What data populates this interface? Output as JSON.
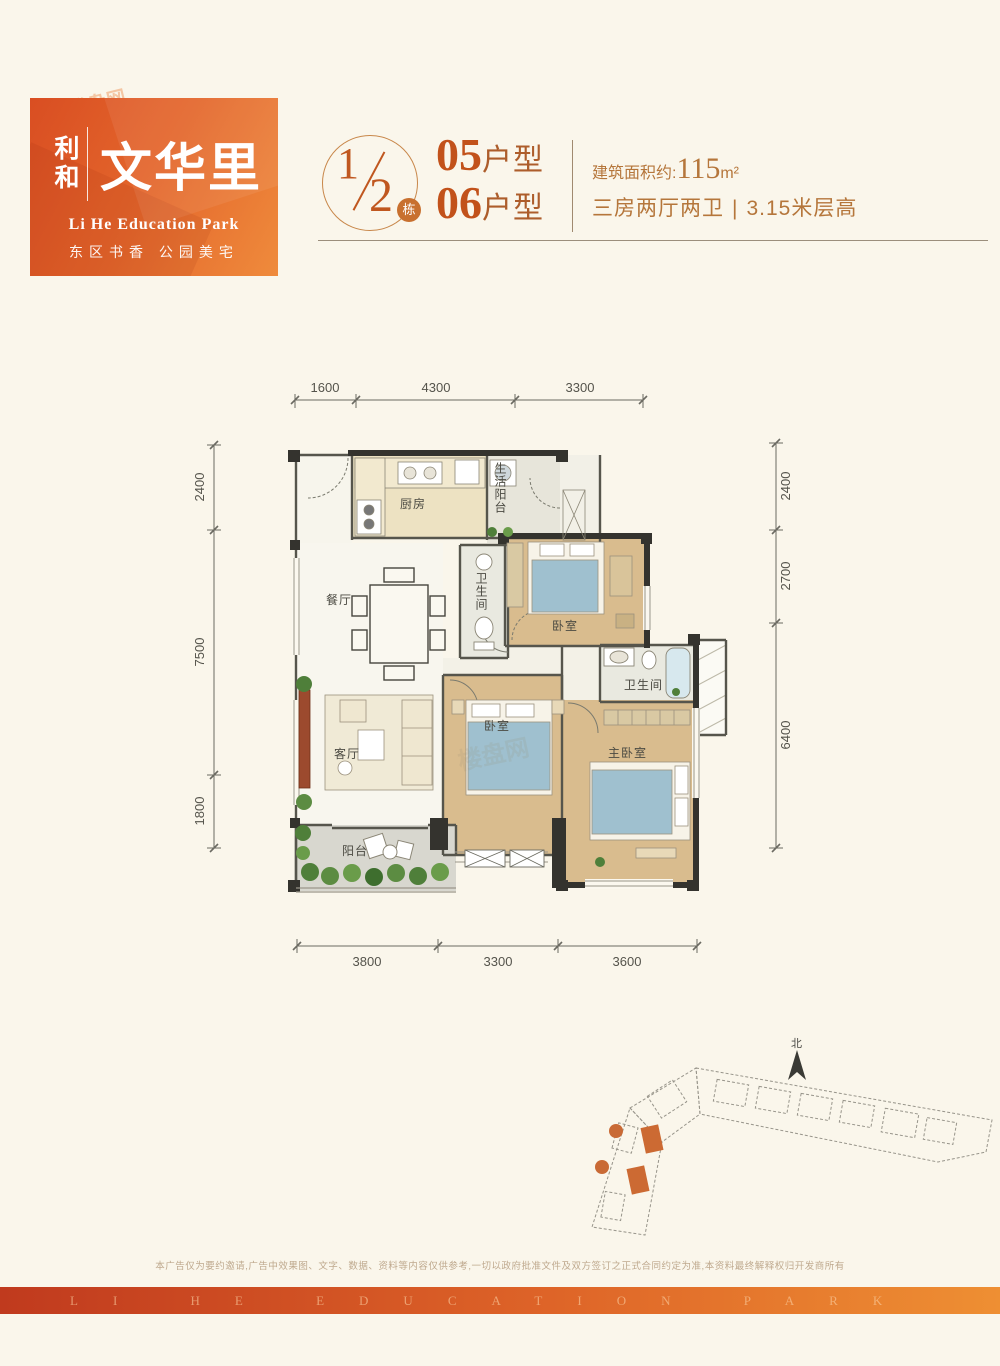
{
  "logo": {
    "brand": "利和",
    "name": "文华里",
    "subtitle_en": "Li He Education Park",
    "tagline": "东区书香 公园美宅"
  },
  "watermark": {
    "text": "楼盘网",
    "url_text": "loupan.com"
  },
  "header": {
    "block_numerator": "1",
    "block_denominator": "2",
    "block_unit": "栋",
    "unit_1": {
      "number": "05",
      "suffix": "户型"
    },
    "unit_2": {
      "number": "06",
      "suffix": "户型"
    },
    "area_label": "建筑面积约:",
    "area_value": "115",
    "area_unit": "m²",
    "layout_text": "三房两厅两卫",
    "divider": "|",
    "height_text": "3.15米层高"
  },
  "plan": {
    "dims_top": [
      "1600",
      "4300",
      "3300"
    ],
    "dims_left": [
      "2400",
      "7500",
      "1800"
    ],
    "dims_right": [
      "2400",
      "2700",
      "6400"
    ],
    "dims_bottom": [
      "3800",
      "3300",
      "3600"
    ],
    "rooms": {
      "kitchen": "厨房",
      "service_balcony": "生活阳台",
      "dining": "餐厅",
      "bath": "卫生间",
      "bedroom1": "卧室",
      "master_bath": "卫生间",
      "living": "客厅",
      "bedroom2": "卧室",
      "master": "主卧室",
      "balcony": "阳台"
    }
  },
  "siteplan": {
    "north_label": "北"
  },
  "footer": {
    "disclaimer": "本广告仅为要约邀请,广告中效果图、文字、数据、资料等内容仅供参考,一切以政府批准文件及双方签订之正式合同约定为准,本资料最终解释权归开发商所有",
    "band_text": "LI HE EDUCATION PARK"
  }
}
